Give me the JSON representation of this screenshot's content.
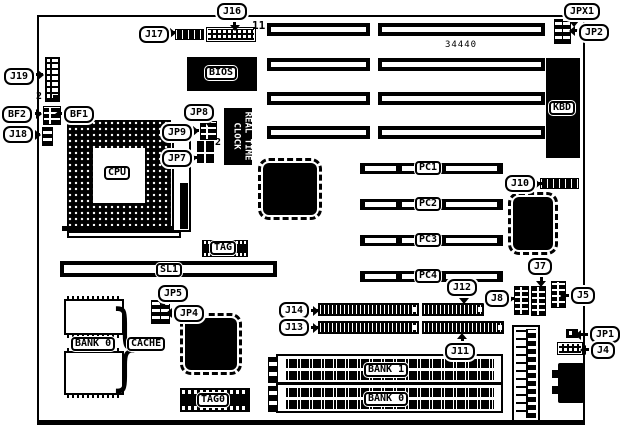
{
  "board": {
    "part_number": "34440"
  },
  "callouts": {
    "j16": "J16",
    "j17": "J17",
    "jpx1": "JPX1",
    "jp2": "JP2",
    "j19": "J19",
    "bf2": "BF2",
    "bf1": "BF1",
    "j18": "J18",
    "jp8": "JP8",
    "jp9": "JP9",
    "jp7": "JP7",
    "j10": "J10",
    "jp5": "JP5",
    "jp4": "JP4",
    "j14": "J14",
    "j13": "J13",
    "j12": "J12",
    "j11": "J11",
    "j8": "J8",
    "j7": "J7",
    "j5": "J5",
    "jp1": "JP1",
    "j4": "J4"
  },
  "chips": {
    "cpu": "CPU",
    "bios": "BIOS",
    "kbd": "KBD",
    "rtc_line1": "REAL TIME",
    "rtc_line2": "CLOCK",
    "tag": "TAG",
    "tag0": "TAG0",
    "cache": "CACHE",
    "cache_bank": "BANK 0"
  },
  "slots": {
    "sl1": "SL1",
    "pci": [
      "PC1",
      "PC2",
      "PC3",
      "PC4"
    ],
    "simm_banks": [
      "BANK 1",
      "BANK 0"
    ]
  },
  "pins": {
    "j16_pin11": "11",
    "j19_pin2": "2",
    "jp7_pin2": "2"
  },
  "decorations": {
    "cache_brace": "}"
  }
}
